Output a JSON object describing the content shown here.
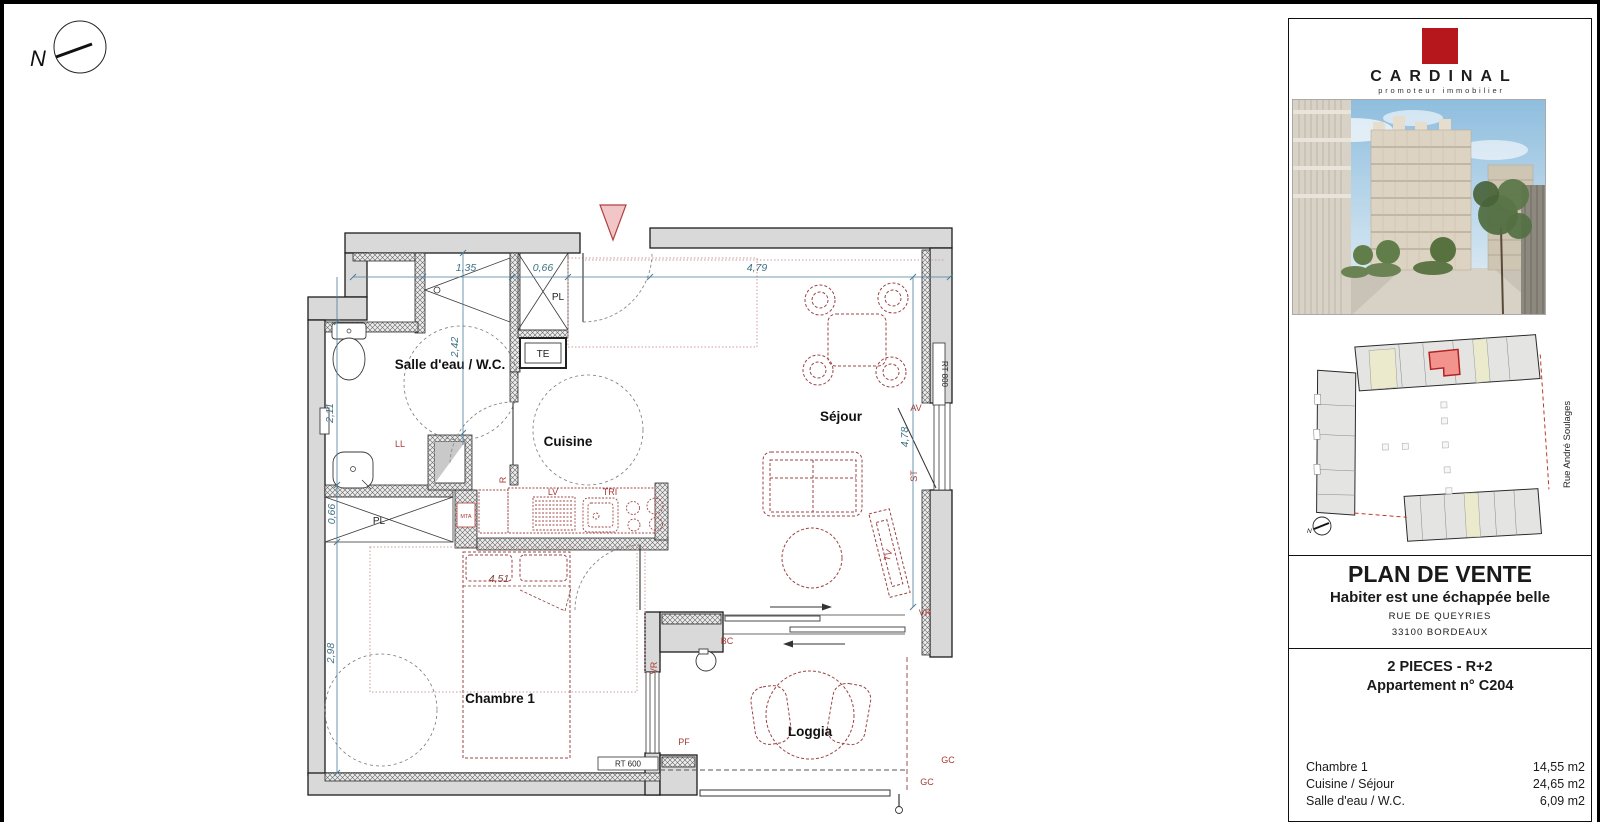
{
  "page": {
    "compass_label": "N"
  },
  "plan": {
    "rooms": {
      "bathroom": "Salle d'eau / W.C.",
      "kitchen": "Cuisine",
      "living": "Séjour",
      "bedroom": "Chambre 1",
      "loggia": "Loggia"
    },
    "dims": {
      "d_135": "1,35",
      "d_066_entry": "0,66",
      "d_242": "2,42",
      "d_211": "2,11",
      "d_479": "4,79",
      "d_478": "4,78",
      "d_066_closet": "0,66",
      "d_298": "2,98",
      "d_451": "4,51"
    },
    "ann": {
      "pl_entry": "PL",
      "te": "TE",
      "pl_bedroom": "PL",
      "ll": "LL",
      "mta": "MTA",
      "fridge": "R",
      "lv": "LV",
      "tri": "TRI",
      "rt800": "RT 800",
      "rt600": "RT 600",
      "av": "AV",
      "st": "ST",
      "tv": "TV",
      "vr_living": "VR",
      "vr_bedroom": "VR",
      "bc": "BC",
      "pf": "PF",
      "gc_side": "GC",
      "gc_bottom": "GC"
    }
  },
  "sidebar": {
    "logo": {
      "brand": "CARDINAL",
      "tagline": "promoteur immobilier"
    },
    "siteplan": {
      "street": "Rue André Soulages",
      "compass_label": "N"
    },
    "titleblock": {
      "title": "PLAN DE VENTE",
      "subtitle": "Habiter est une échappée belle",
      "address1": "RUE DE QUEYRIES",
      "address2": "33100 BORDEAUX",
      "unit_type": "2 PIECES - R+2",
      "unit_name": "Appartement n° C204"
    },
    "areas": [
      {
        "room": "Chambre 1",
        "value": "14,55 m2"
      },
      {
        "room": "Cuisine / Séjour",
        "value": "24,65 m2"
      },
      {
        "room": "Salle d'eau / W.C.",
        "value": "6,09 m2"
      }
    ]
  },
  "colors": {
    "brand_red": "#b5171d",
    "dim_blue": "#3d7286",
    "annotation_red": "#a93b35",
    "furniture_red": "#9c4444",
    "highlight_unit": "#f0918c"
  }
}
